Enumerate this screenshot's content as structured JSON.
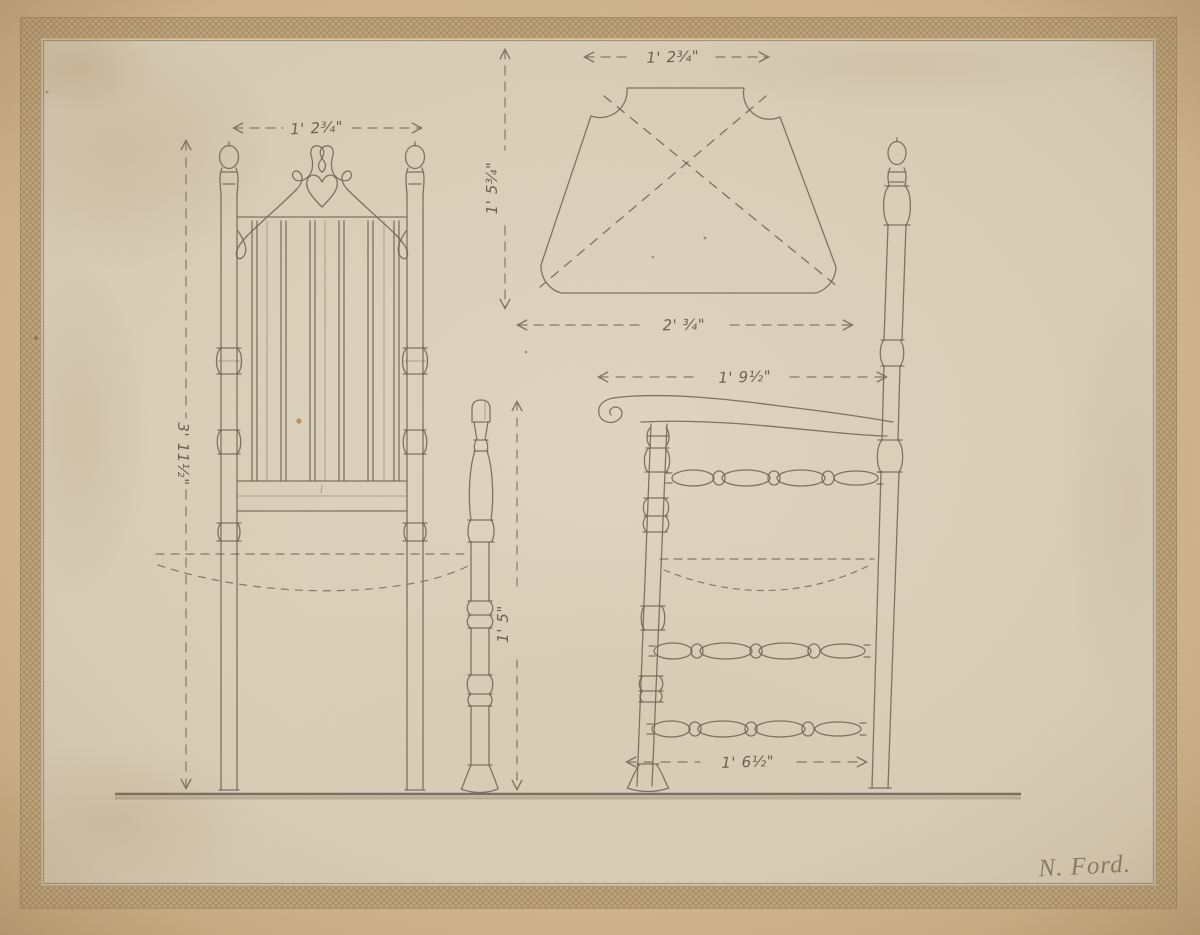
{
  "dimensions": {
    "front_width": "1' 2¾\"",
    "front_height": "3' 11½\"",
    "plan_width_top": "1' 2¾\"",
    "plan_depth": "1' 5¾\"",
    "plan_width_bottom": "2' ¾\"",
    "front_post_height": "1' 5\"",
    "side_width_top": "1' 9½\"",
    "side_width_bottom": "1' 6½\""
  },
  "signature": {
    "text": "N. Ford."
  },
  "colors": {
    "paper_outer": "#d2b78f",
    "paper_inner": "#ddd2bd",
    "pencil": "#6d6254"
  }
}
